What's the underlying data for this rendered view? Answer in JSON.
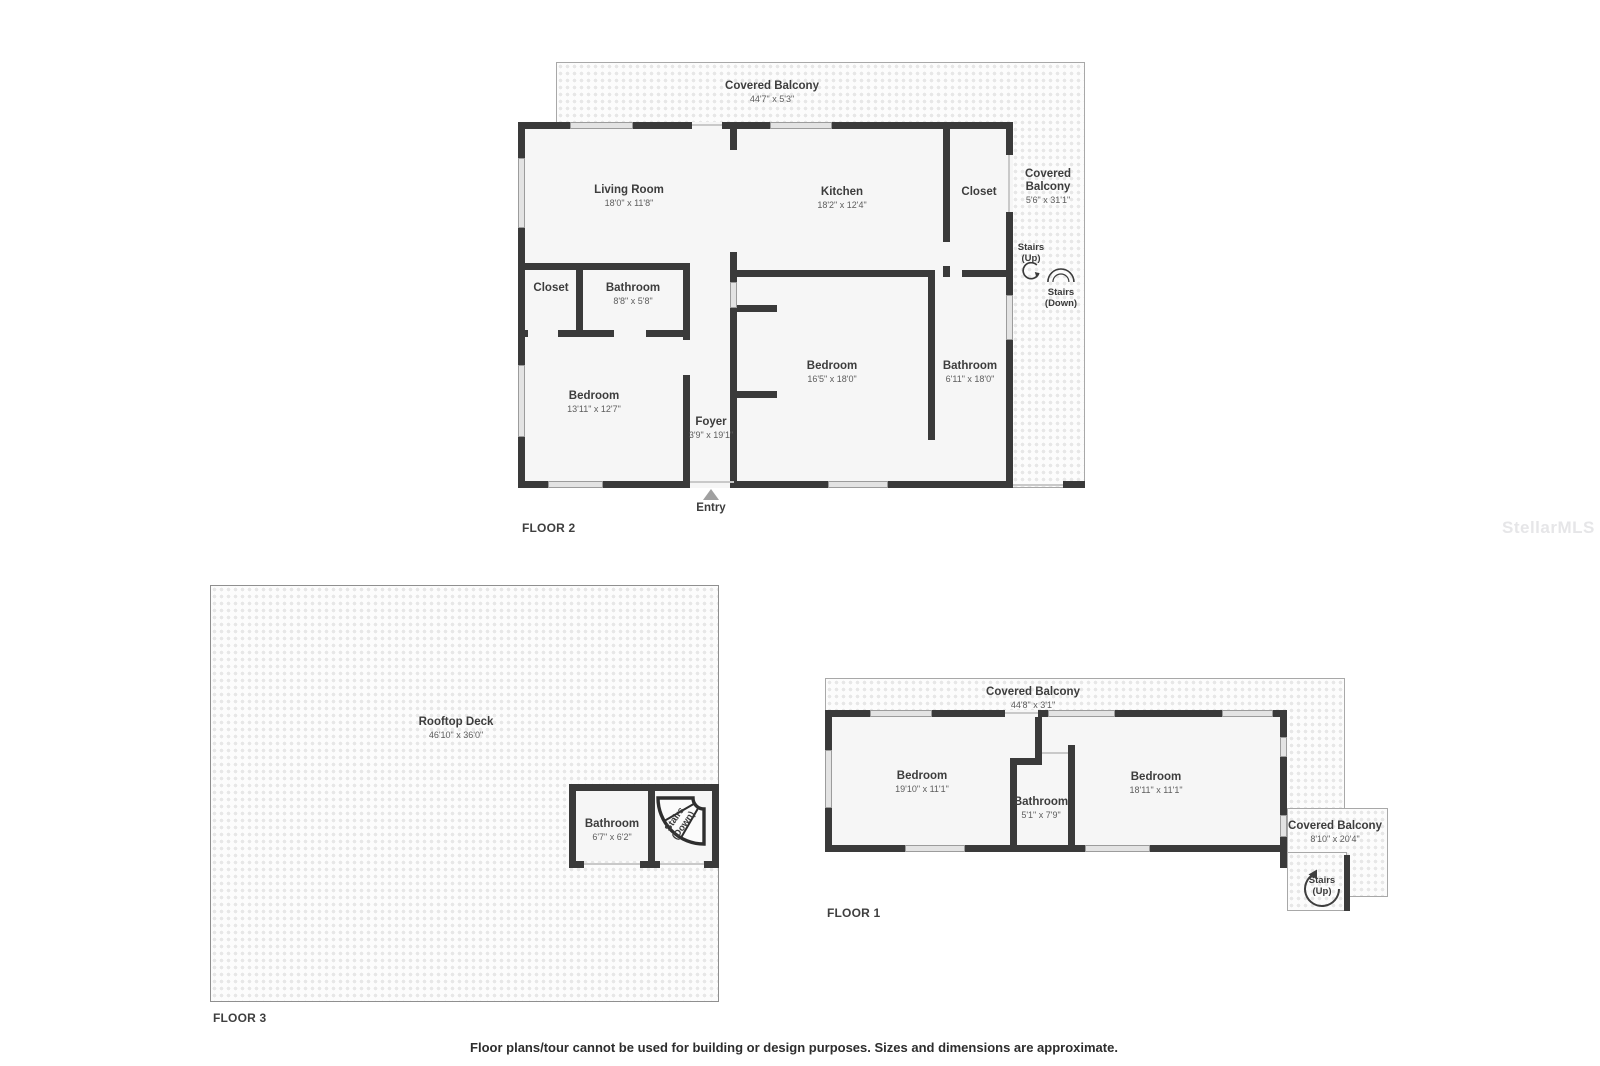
{
  "watermark": "StellarMLS",
  "disclaimer": "Floor plans/tour cannot be used for building or design purposes. Sizes and dimensions are approximate.",
  "floor2": {
    "label": "FLOOR 2",
    "balcony_top": {
      "name": "Covered Balcony",
      "dims": "44'7\" x 5'3\""
    },
    "balcony_right": {
      "name_line1": "Covered",
      "name_line2": "Balcony",
      "dims": "5'6\" x 31'1\""
    },
    "living_room": {
      "name": "Living Room",
      "dims": "18'0\" x 11'8\""
    },
    "kitchen": {
      "name": "Kitchen",
      "dims": "18'2\" x 12'4\""
    },
    "closet_top": {
      "name": "Closet"
    },
    "closet_left": {
      "name": "Closet"
    },
    "bathroom_small": {
      "name": "Bathroom",
      "dims": "8'8\" x 5'8\""
    },
    "bedroom_left": {
      "name": "Bedroom",
      "dims": "13'11\" x 12'7\""
    },
    "foyer": {
      "name": "Foyer",
      "dims": "3'9\" x 19'1\""
    },
    "bedroom_main": {
      "name": "Bedroom",
      "dims": "16'5\" x 18'0\""
    },
    "bathroom_main": {
      "name": "Bathroom",
      "dims": "6'11\" x 18'0\""
    },
    "stairs_up": {
      "line1": "Stairs",
      "line2": "(Up)"
    },
    "stairs_down": {
      "line1": "Stairs",
      "line2": "(Down)"
    },
    "entry": "Entry"
  },
  "floor3": {
    "label": "FLOOR 3",
    "rooftop_deck": {
      "name": "Rooftop Deck",
      "dims": "46'10\" x 36'0\""
    },
    "bathroom": {
      "name": "Bathroom",
      "dims": "6'7\" x 6'2\""
    },
    "stairs_down": {
      "line1": "Stairs",
      "line2": "(Down)"
    }
  },
  "floor1": {
    "label": "FLOOR 1",
    "balcony_top": {
      "name": "Covered Balcony",
      "dims": "44'8\" x 3'1\""
    },
    "balcony_right": {
      "name": "Covered Balcony",
      "dims": "8'10\" x 20'4\""
    },
    "bedroom_left": {
      "name": "Bedroom",
      "dims": "19'10\" x 11'1\""
    },
    "bathroom": {
      "name": "Bathroom",
      "dims": "5'1\" x 7'9\""
    },
    "bedroom_right": {
      "name": "Bedroom",
      "dims": "18'11\" x 11'1\""
    },
    "stairs_up": {
      "line1": "Stairs",
      "line2": "(Up)"
    }
  },
  "colors": {
    "wall": "#3a3a3a",
    "room_fill": "#f6f6f6",
    "hatch_dot": "#e7e7e7",
    "accent_text": "#3d3d3d"
  }
}
